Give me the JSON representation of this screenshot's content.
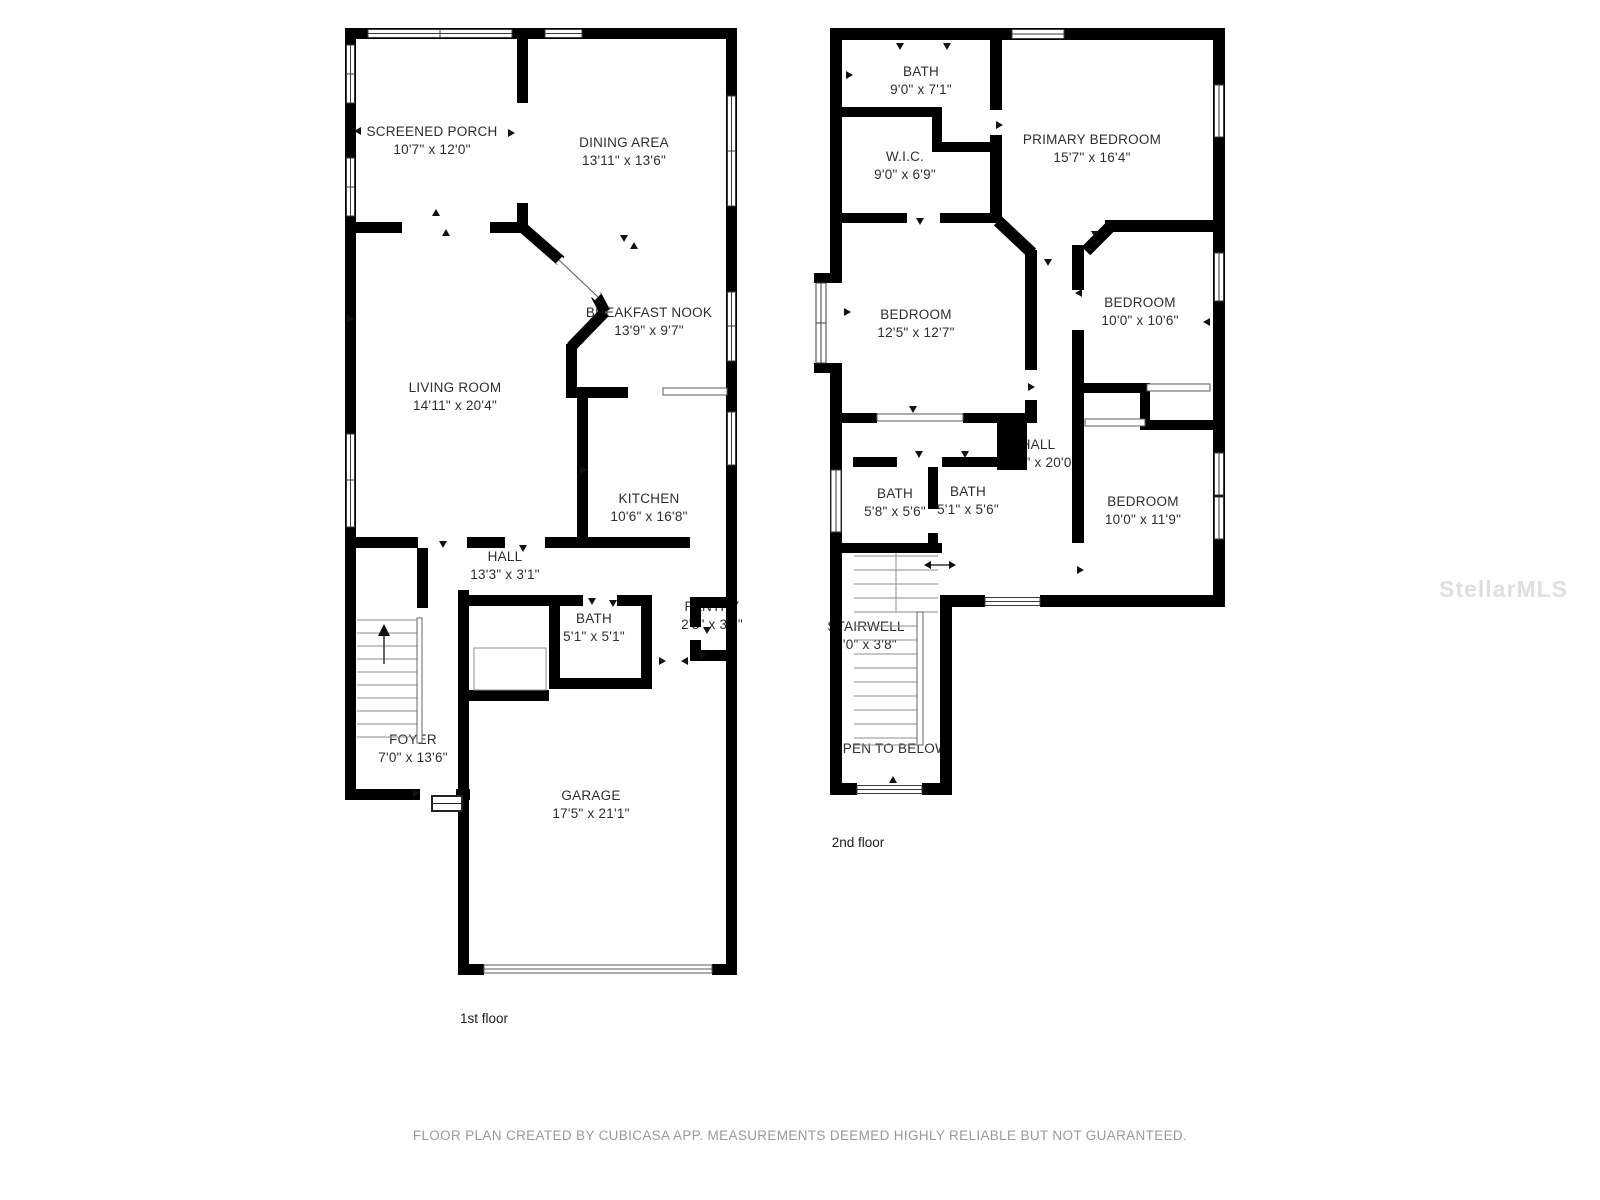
{
  "page": {
    "background": "#ffffff"
  },
  "floor1": {
    "label": "1st floor",
    "rooms": [
      {
        "name": "SCREENED PORCH",
        "dims": "10'7\" x 12'0\""
      },
      {
        "name": "DINING AREA",
        "dims": "13'11\" x 13'6\""
      },
      {
        "name": "BREAKFAST NOOK",
        "dims": "13'9\" x 9'7\""
      },
      {
        "name": "LIVING ROOM",
        "dims": "14'11\" x 20'4\""
      },
      {
        "name": "KITCHEN",
        "dims": "10'6\" x 16'8\""
      },
      {
        "name": "HALL",
        "dims": "13'3\" x 3'1\""
      },
      {
        "name": "BATH",
        "dims": "5'1\" x 5'1\""
      },
      {
        "name": "PANTRY",
        "dims": "2'3\" x 3'3\""
      },
      {
        "name": "FOYER",
        "dims": "7'0\" x 13'6\""
      },
      {
        "name": "GARAGE",
        "dims": "17'5\" x 21'1\""
      }
    ]
  },
  "floor2": {
    "label": "2nd floor",
    "rooms": [
      {
        "name": "BATH",
        "dims": "9'0\" x 7'1\""
      },
      {
        "name": "W.I.C.",
        "dims": "9'0\" x 6'9\""
      },
      {
        "name": "PRIMARY BEDROOM",
        "dims": "15'7\" x 16'4\""
      },
      {
        "name": "BEDROOM",
        "dims": "12'5\" x 12'7\""
      },
      {
        "name": "BEDROOM",
        "dims": "10'0\" x 10'6\""
      },
      {
        "name": "HALL",
        "dims": "7'10\" x 20'0\""
      },
      {
        "name": "BATH",
        "dims": "5'8\" x 5'6\""
      },
      {
        "name": "BATH",
        "dims": "5'1\" x 5'6\""
      },
      {
        "name": "BEDROOM",
        "dims": "10'0\" x 11'9\""
      },
      {
        "name": "STAIRWELL",
        "dims": "0'0\" x 3'8\""
      },
      {
        "name": "OPEN TO BELOW",
        "dims": ""
      }
    ]
  },
  "watermark": "StellarMLS",
  "footer": {
    "disclaimer": "FLOOR PLAN CREATED BY CUBICASA APP. MEASUREMENTS DEEMED HIGHLY RELIABLE BUT NOT GUARANTEED."
  },
  "colors": {
    "wall": "#000000",
    "background": "#ffffff",
    "room_text": "#2e2e2e",
    "footer_text": "#9a9a9a",
    "watermark_text": "#aaaaaa"
  }
}
